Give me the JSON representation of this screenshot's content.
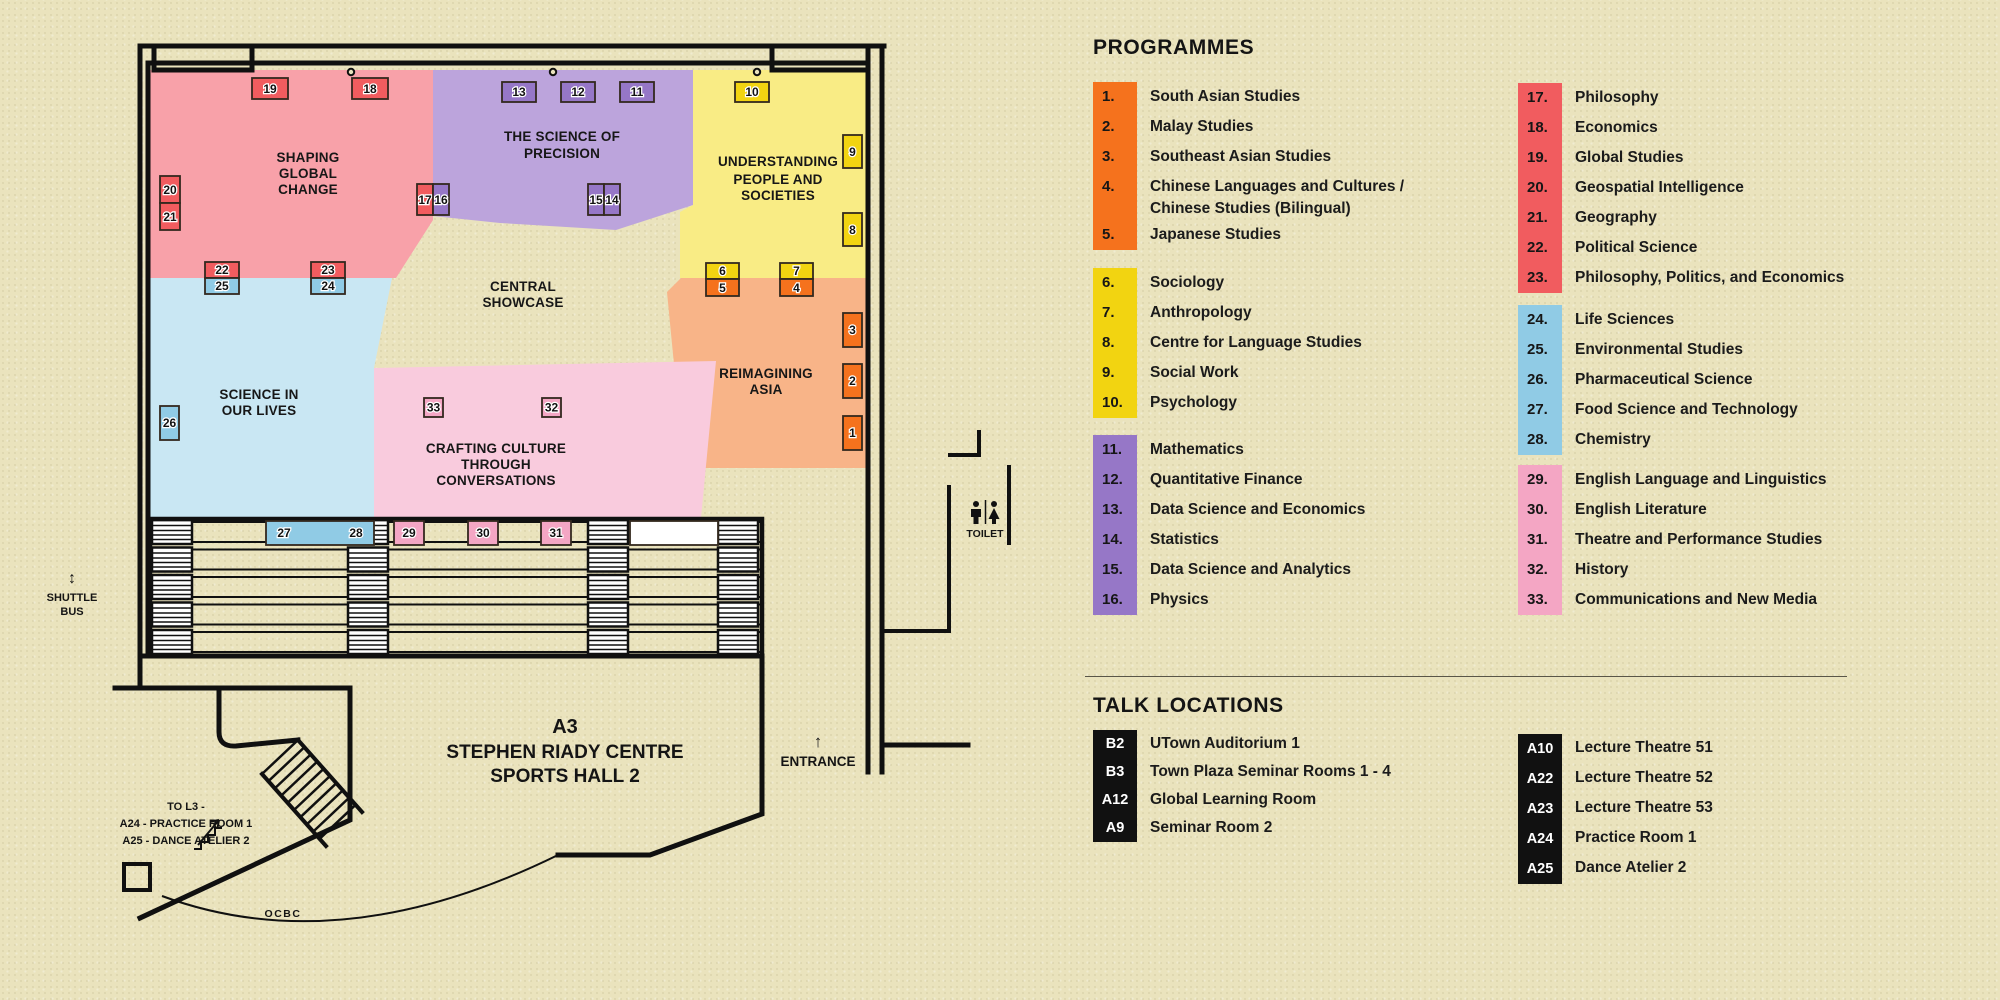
{
  "colors": {
    "orange": "#F5721D",
    "yellow": "#F2D411",
    "purple": "#9677C7",
    "red": "#F15C5F",
    "blue": "#90CBE5",
    "pink": "#F4A6C4",
    "zone_pink": "#F8A1A9",
    "zone_purple": "#BCA4DC",
    "zone_yellow": "#F9EC85",
    "zone_orange": "#F8B488",
    "zone_blue": "#C9E7F3",
    "zone_craft_pink": "#F9CBDD",
    "chip_black": "#111111",
    "chip_text_white": "#FFFFFF",
    "booth_white": "#FFFFFF"
  },
  "map": {
    "zones": {
      "shaping": [
        "SHAPING",
        "GLOBAL",
        "CHANGE"
      ],
      "precision": [
        "THE SCIENCE OF",
        "PRECISION"
      ],
      "understanding": [
        "UNDERSTANDING",
        "PEOPLE AND",
        "SOCIETIES"
      ],
      "central": [
        "CENTRAL",
        "SHOWCASE"
      ],
      "reimagining": [
        "REIMAGINING",
        "ASIA"
      ],
      "science": [
        "SCIENCE IN",
        "OUR LIVES"
      ],
      "crafting": [
        "CRAFTING CULTURE",
        "THROUGH",
        "CONVERSATIONS"
      ]
    },
    "booths": {
      "b1": "1",
      "b2": "2",
      "b3": "3",
      "b4": "4",
      "b5": "5",
      "b6": "6",
      "b7": "7",
      "b8": "8",
      "b9": "9",
      "b10": "10",
      "b11": "11",
      "b12": "12",
      "b13": "13",
      "b14": "14",
      "b15": "15",
      "b16": "16",
      "b17": "17",
      "b18": "18",
      "b19": "19",
      "b20": "20",
      "b21": "21",
      "b22": "22",
      "b23": "23",
      "b24": "24",
      "b25": "25",
      "b26": "26",
      "b27": "27",
      "b28": "28",
      "b29": "29",
      "b30": "30",
      "b31": "31",
      "b32": "32",
      "b33": "33"
    },
    "labels": {
      "shuttle_arrow": "↕",
      "shuttle_line1": "SHUTTLE",
      "shuttle_line2": "BUS",
      "to_l3_line1": "TO L3 -",
      "to_l3_line2": "A24 - PRACTICE ROOM 1",
      "to_l3_line3": "A25 - DANCE ATELIER 2",
      "hall_line1": "A3",
      "hall_line2": "STEPHEN RIADY CENTRE",
      "hall_line3": "SPORTS HALL 2",
      "ocbc": "OCBC",
      "entrance_arrow": "↑",
      "entrance": "ENTRANCE",
      "toilet": "TOILET"
    }
  },
  "programmes": {
    "title": "PROGRAMMES",
    "groups": [
      {
        "color_key": "orange",
        "items": [
          {
            "num": "1.",
            "label": "South Asian Studies"
          },
          {
            "num": "2.",
            "label": "Malay Studies"
          },
          {
            "num": "3.",
            "label": "Southeast Asian Studies"
          },
          {
            "num": "4.",
            "label": "Chinese Languages and Cultures / Chinese Studies (Bilingual)"
          },
          {
            "num": "5.",
            "label": "Japanese Studies"
          }
        ]
      },
      {
        "color_key": "yellow",
        "items": [
          {
            "num": "6.",
            "label": "Sociology"
          },
          {
            "num": "7.",
            "label": "Anthropology"
          },
          {
            "num": "8.",
            "label": "Centre for Language Studies"
          },
          {
            "num": "9.",
            "label": "Social Work"
          },
          {
            "num": "10.",
            "label": "Psychology"
          }
        ]
      },
      {
        "color_key": "purple",
        "items": [
          {
            "num": "11.",
            "label": "Mathematics"
          },
          {
            "num": "12.",
            "label": "Quantitative Finance"
          },
          {
            "num": "13.",
            "label": "Data Science and Economics"
          },
          {
            "num": "14.",
            "label": "Statistics"
          },
          {
            "num": "15.",
            "label": "Data Science and Analytics"
          },
          {
            "num": "16.",
            "label": "Physics"
          }
        ]
      },
      {
        "color_key": "red",
        "items": [
          {
            "num": "17.",
            "label": "Philosophy"
          },
          {
            "num": "18.",
            "label": "Economics"
          },
          {
            "num": "19.",
            "label": "Global Studies"
          },
          {
            "num": "20.",
            "label": "Geospatial Intelligence"
          },
          {
            "num": "21.",
            "label": "Geography"
          },
          {
            "num": "22.",
            "label": "Political Science"
          },
          {
            "num": "23.",
            "label": "Philosophy, Politics, and Economics"
          }
        ]
      },
      {
        "color_key": "blue",
        "items": [
          {
            "num": "24.",
            "label": "Life Sciences"
          },
          {
            "num": "25.",
            "label": "Environmental Studies"
          },
          {
            "num": "26.",
            "label": "Pharmaceutical Science"
          },
          {
            "num": "27.",
            "label": "Food Science and Technology"
          },
          {
            "num": "28.",
            "label": "Chemistry"
          }
        ]
      },
      {
        "color_key": "pink",
        "items": [
          {
            "num": "29.",
            "label": "English Language and Linguistics"
          },
          {
            "num": "30.",
            "label": "English Literature"
          },
          {
            "num": "31.",
            "label": "Theatre and Performance Studies"
          },
          {
            "num": "32.",
            "label": "History"
          },
          {
            "num": "33.",
            "label": "Communications and New Media"
          }
        ]
      }
    ]
  },
  "talk_locations": {
    "title": "TALK LOCATIONS",
    "left": [
      {
        "code": "B2",
        "label": "UTown Auditorium 1"
      },
      {
        "code": "B3",
        "label": "Town Plaza Seminar Rooms 1 - 4"
      },
      {
        "code": "A12",
        "label": "Global Learning Room"
      },
      {
        "code": "A9",
        "label": "Seminar Room 2"
      }
    ],
    "right": [
      {
        "code": "A10",
        "label": "Lecture Theatre 51"
      },
      {
        "code": "A22",
        "label": "Lecture Theatre 52"
      },
      {
        "code": "A23",
        "label": "Lecture Theatre 53"
      },
      {
        "code": "A24",
        "label": "Practice Room 1"
      },
      {
        "code": "A25",
        "label": "Dance Atelier 2"
      }
    ]
  }
}
